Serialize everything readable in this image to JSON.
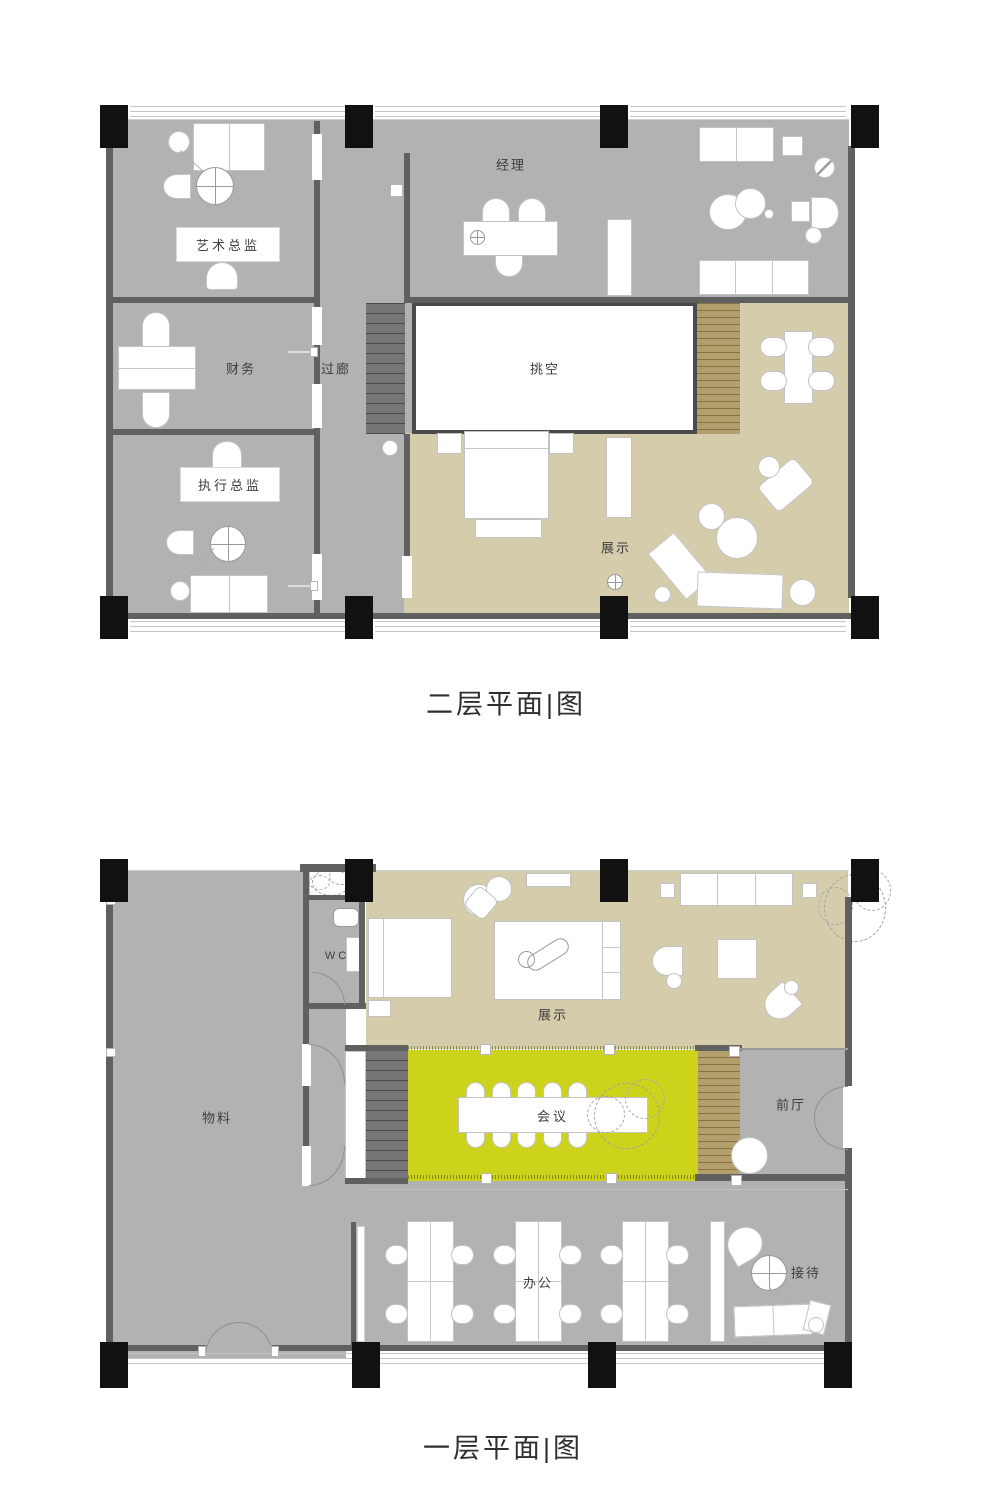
{
  "palette": {
    "floor-gray": "#b2b2b2",
    "floor-tan": "#d5ccac",
    "floor-yellow": "#ccd31a",
    "wall": "#606060",
    "column": "#111111",
    "stair-dark-base": "#767676",
    "stair-wood-base": "#b29f6c",
    "ink": "#3d3d3d"
  },
  "floor2": {
    "title": "二层平面|图",
    "rooms": {
      "art_director": "艺术总监",
      "finance": "财务",
      "corridor": "过廊",
      "manager": "经理",
      "void": "挑空",
      "executive_director": "执行总监",
      "display": "展示"
    }
  },
  "floor1": {
    "title": "一层平面|图",
    "rooms": {
      "materials": "物料",
      "wc": "WC",
      "display": "展示",
      "meeting": "会议",
      "front_hall": "前厅",
      "office": "办公",
      "reception": "接待"
    }
  }
}
